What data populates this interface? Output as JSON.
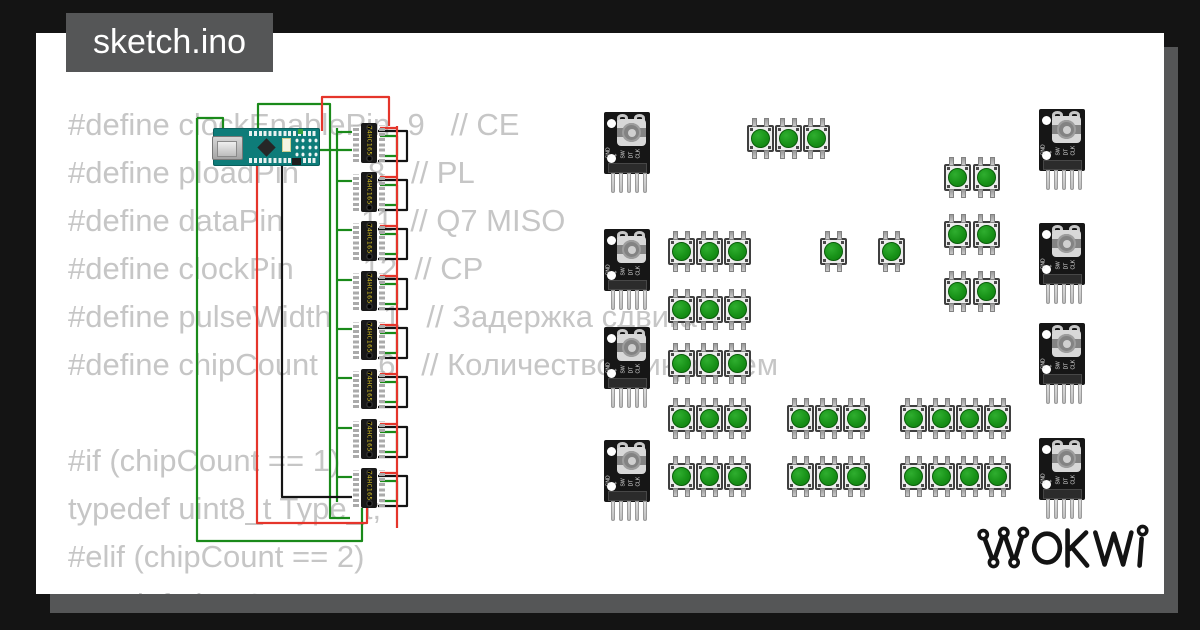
{
  "window": {
    "tab_label": "sketch.ino",
    "background_color": "#141414",
    "canvas_color": "#ffffff",
    "shadow_color": "#555657",
    "tab_color": "#555657"
  },
  "code": {
    "text_color": "#c6c6c6",
    "lines": [
      "#define clockEnablePin  9   // CE",
      "#define ploadPin        8   // PL",
      "#define dataPin         11  // Q7 MISO",
      "#define clockPin        12  // CP",
      "#define pulseWidth      1   // Задержка сдвига",
      "#define chipCount       6   // Количество микросхем",
      "",
      "#if (chipCount == 1)",
      "typedef uint8_t Type_t;",
      "#elif (chipCount == 2)",
      "typedef uint16_t Type_t;"
    ]
  },
  "diagram": {
    "wire_colors": {
      "green": "#1a8a1a",
      "red": "#e5352b",
      "black": "#141414"
    },
    "wires": [
      {
        "color": "green",
        "points": [
          [
            197,
            118
          ],
          [
            197,
            541
          ],
          [
            362,
            541
          ],
          [
            362,
            508
          ]
        ]
      },
      {
        "color": "green",
        "points": [
          [
            223,
            131
          ],
          [
            223,
            118
          ],
          [
            197,
            118
          ]
        ]
      },
      {
        "color": "green",
        "points": [
          [
            258,
            131
          ],
          [
            258,
            104
          ],
          [
            330,
            104
          ],
          [
            330,
            518
          ],
          [
            350,
            518
          ]
        ]
      },
      {
        "color": "green",
        "points": [
          [
            337,
            128
          ],
          [
            337,
            502
          ]
        ]
      },
      {
        "color": "green",
        "points": [
          [
            318,
            150
          ],
          [
            352,
            150
          ]
        ]
      },
      {
        "color": "red",
        "points": [
          [
            257,
            163
          ],
          [
            257,
            523
          ],
          [
            367,
            523
          ],
          [
            367,
            508
          ]
        ]
      },
      {
        "color": "red",
        "points": [
          [
            322,
            131
          ],
          [
            322,
            97
          ],
          [
            389,
            97
          ],
          [
            389,
            126
          ]
        ]
      },
      {
        "color": "red",
        "points": [
          [
            397,
            126
          ],
          [
            397,
            528
          ]
        ]
      },
      {
        "color": "black",
        "points": [
          [
            282,
            163
          ],
          [
            282,
            497
          ],
          [
            352,
            497
          ]
        ]
      }
    ],
    "chip_connectors": {
      "black_bracket": [
        [
          25,
          8
        ],
        [
          54,
          8
        ],
        [
          54,
          38
        ],
        [
          25,
          38
        ]
      ],
      "green_bracket": [
        [
          27,
          13
        ],
        [
          44,
          13
        ],
        [
          44,
          33
        ],
        [
          27,
          33
        ]
      ],
      "green_stub": [
        [
          -16,
          9
        ],
        [
          -1,
          9
        ]
      ],
      "red_stub": [
        [
          27,
          5
        ],
        [
          44,
          5
        ]
      ]
    },
    "components": {
      "nano": {
        "x": 213,
        "y": 128
      },
      "chips": {
        "x": 353,
        "label": "74HC165",
        "ys": [
          123,
          172,
          221,
          271,
          320,
          369,
          419,
          468
        ]
      },
      "encoders": [
        {
          "x": 604,
          "y": 112
        },
        {
          "x": 604,
          "y": 229
        },
        {
          "x": 604,
          "y": 327
        },
        {
          "x": 604,
          "y": 440
        },
        {
          "x": 1039,
          "y": 109
        },
        {
          "x": 1039,
          "y": 223
        },
        {
          "x": 1039,
          "y": 323
        },
        {
          "x": 1039,
          "y": 438
        }
      ],
      "encoder_pin_labels": [
        "GND",
        "+",
        "SW",
        "DT",
        "CLK"
      ],
      "buttons": [
        [
          747,
          125
        ],
        [
          775,
          125
        ],
        [
          803,
          125
        ],
        [
          944,
          164
        ],
        [
          973,
          164
        ],
        [
          944,
          221
        ],
        [
          973,
          221
        ],
        [
          944,
          278
        ],
        [
          973,
          278
        ],
        [
          668,
          238
        ],
        [
          696,
          238
        ],
        [
          724,
          238
        ],
        [
          820,
          238
        ],
        [
          878,
          238
        ],
        [
          668,
          296
        ],
        [
          696,
          296
        ],
        [
          724,
          296
        ],
        [
          668,
          350
        ],
        [
          696,
          350
        ],
        [
          724,
          350
        ],
        [
          668,
          405
        ],
        [
          696,
          405
        ],
        [
          724,
          405
        ],
        [
          787,
          405
        ],
        [
          815,
          405
        ],
        [
          843,
          405
        ],
        [
          900,
          405
        ],
        [
          928,
          405
        ],
        [
          956,
          405
        ],
        [
          984,
          405
        ],
        [
          668,
          463
        ],
        [
          696,
          463
        ],
        [
          724,
          463
        ],
        [
          787,
          463
        ],
        [
          815,
          463
        ],
        [
          843,
          463
        ],
        [
          900,
          463
        ],
        [
          928,
          463
        ],
        [
          956,
          463
        ],
        [
          984,
          463
        ]
      ]
    }
  },
  "logo": {
    "text": "WOKWI",
    "color": "#131313"
  }
}
